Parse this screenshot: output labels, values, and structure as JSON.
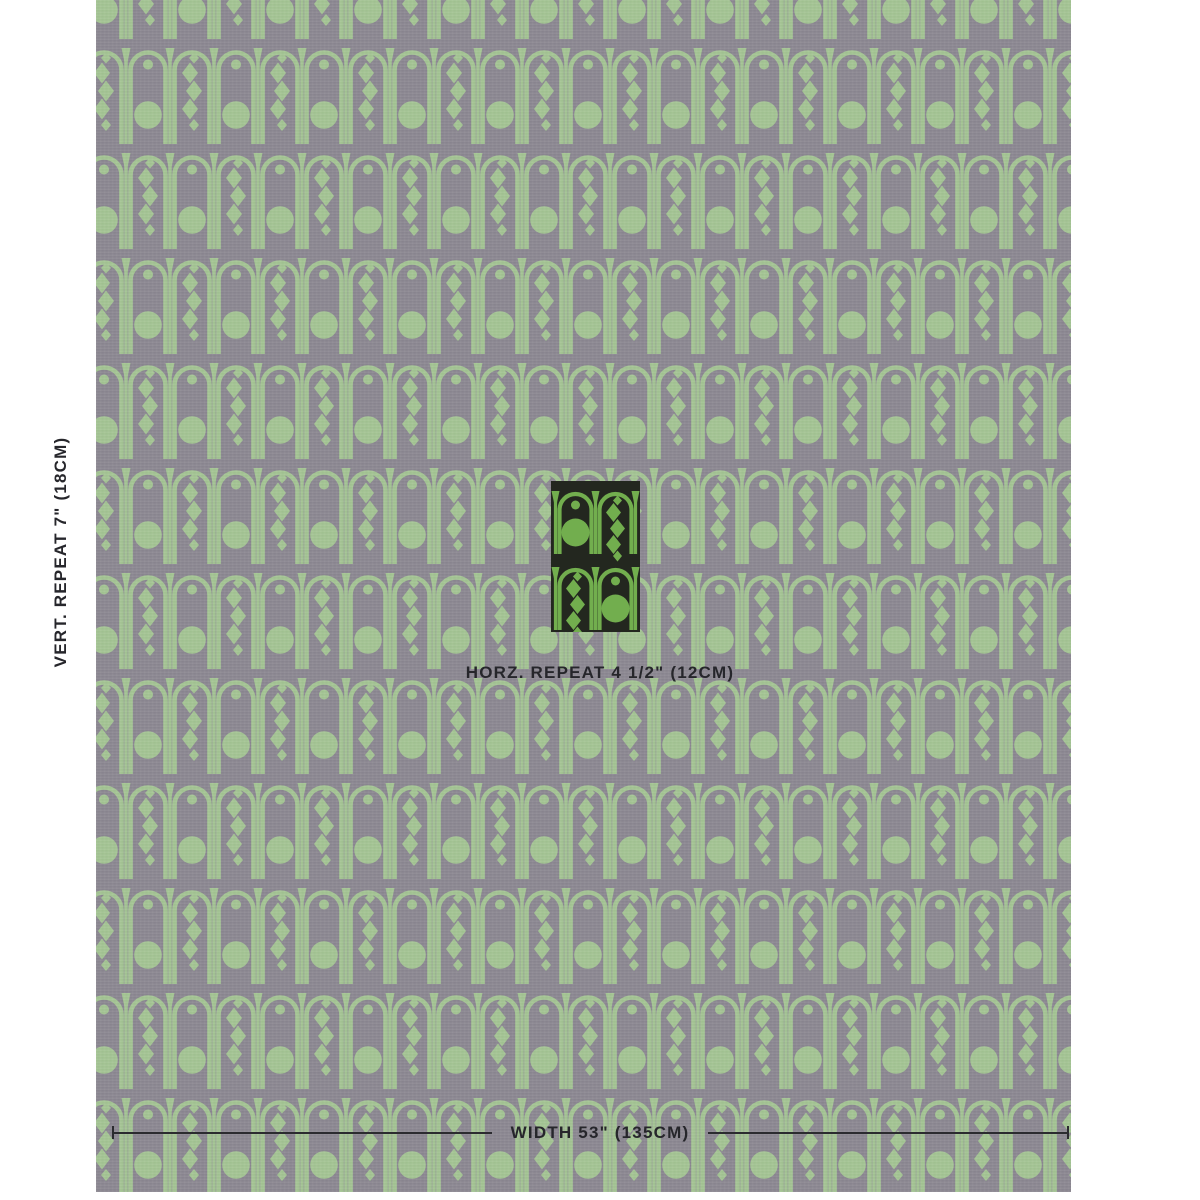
{
  "colors": {
    "page_bg": "#ffffff",
    "fabric_gray": "#8b8791",
    "fabric_green": "#a3c493",
    "swatch_bg": "#23271f",
    "swatch_green": "#72ae4e",
    "annotation_text": "#26262b",
    "dimension_line": "#2b2b2f"
  },
  "annotations": {
    "vertical_repeat": "VERT. REPEAT 7\" (18CM)",
    "horizontal_repeat": "HORZ. REPEAT 4 1/2\" (12CM)",
    "width": "WIDTH 53\" (135CM)"
  }
}
